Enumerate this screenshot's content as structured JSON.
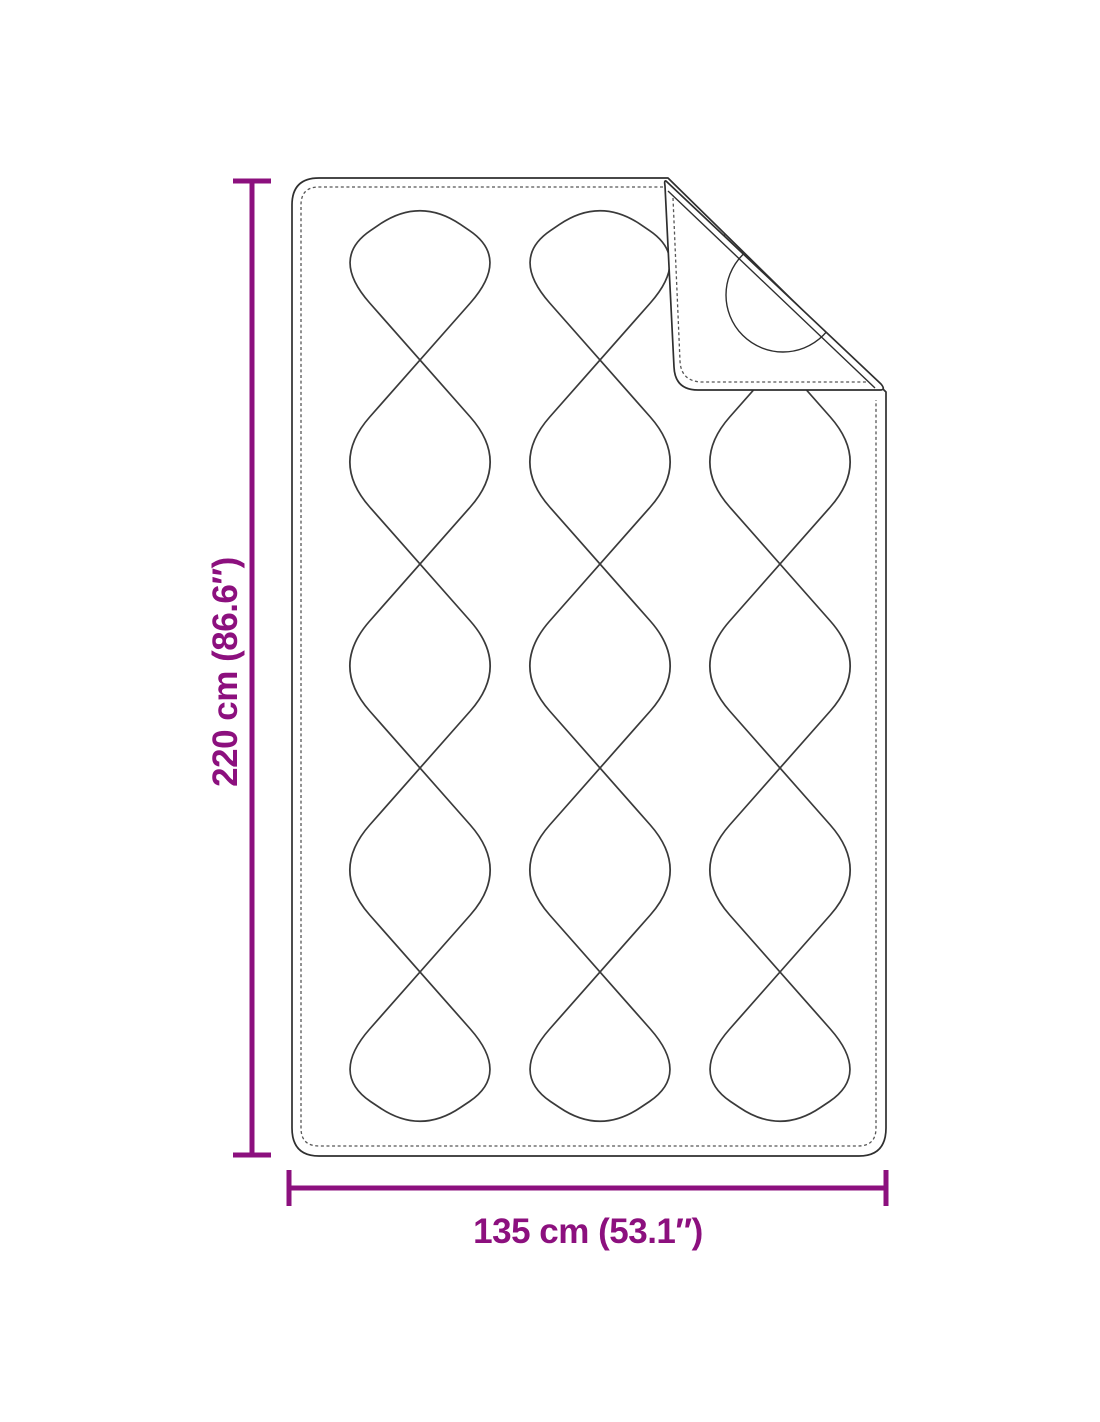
{
  "diagram": {
    "title": "quilted-blanket-dimension-diagram",
    "product": "quilted blanket with folded top-right corner",
    "height_label": "220 cm (86.6″)",
    "width_label": "135 cm (53.1″)"
  },
  "colors": {
    "dimension": "#8C107E",
    "outline": "#2F2F2F",
    "stitch": "#565656",
    "quilt_line": "#3A3A3A",
    "background": "#FFFFFF"
  }
}
